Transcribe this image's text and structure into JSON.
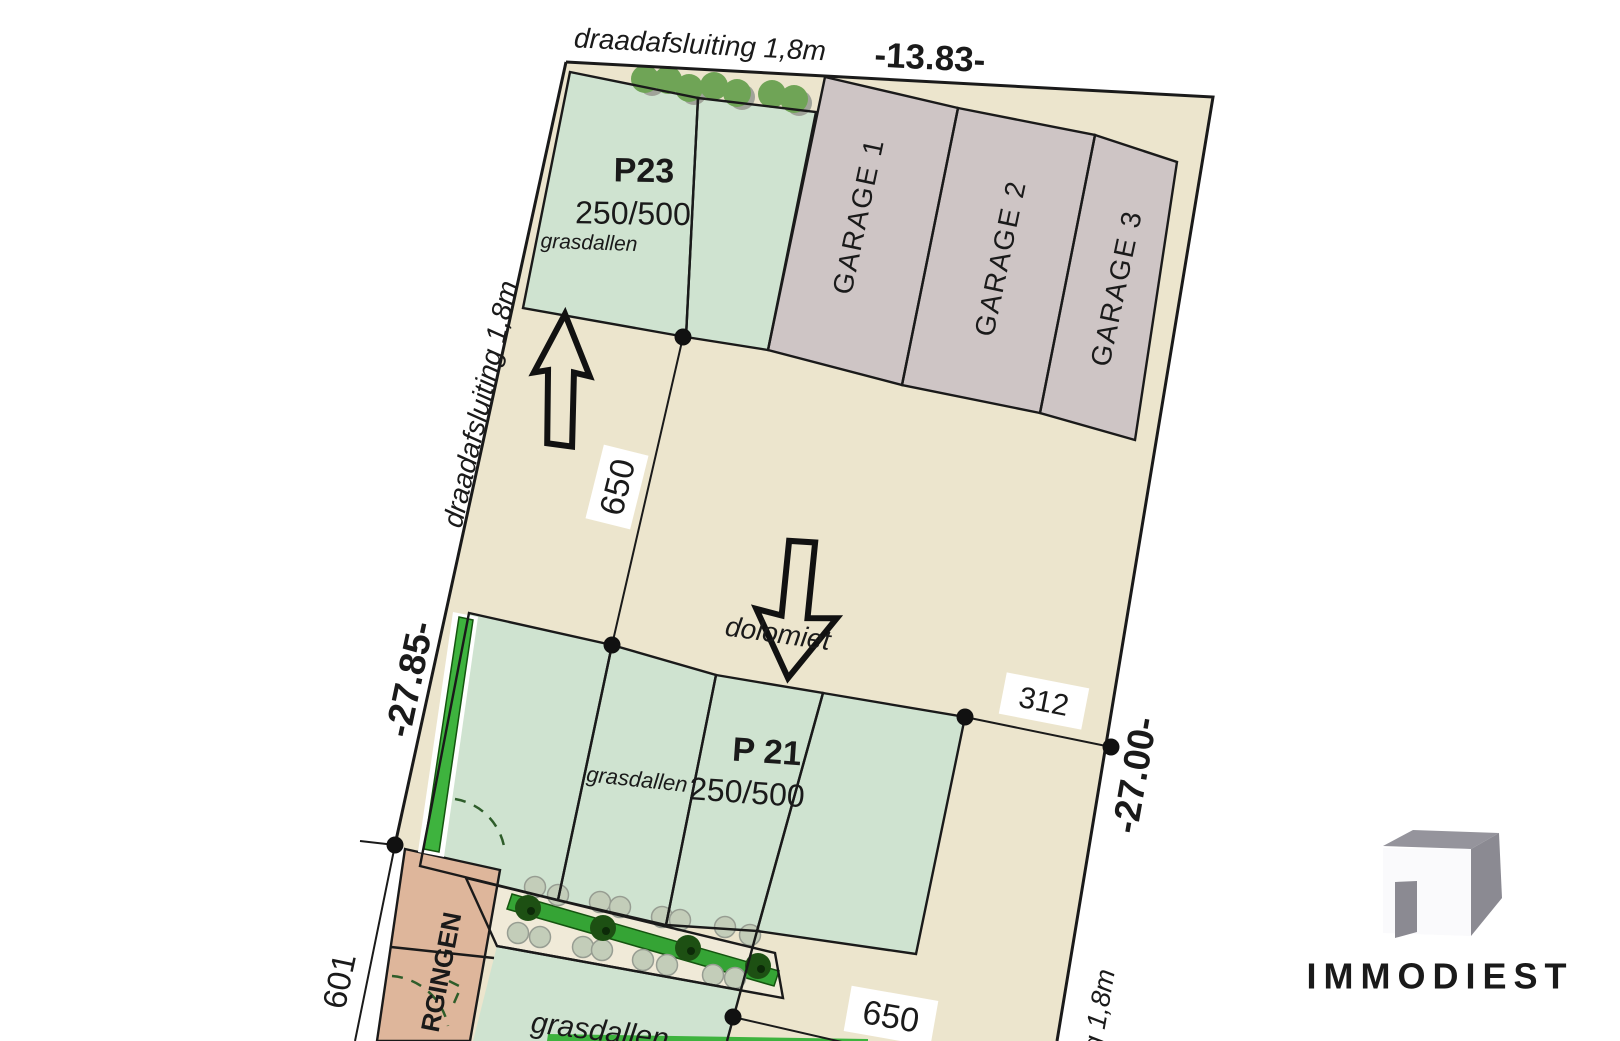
{
  "plan": {
    "boundaries": {
      "top_fence": "draadafsluiting 1,8m",
      "top_length": "-13.83-",
      "left_fence": "draadafsluiting 1,8m",
      "left_length": "-27.85-",
      "right_length": "-27.00-",
      "right_fence": "ting 1,8m"
    },
    "dimensions": {
      "depth_upper": "650",
      "depth_lower": "650",
      "width_312": "312",
      "left_601": "601"
    },
    "p23": {
      "code": "P23",
      "size": "250/500",
      "surface": "grasdallen"
    },
    "p21": {
      "code": "P 21",
      "size": "250/500",
      "surface": "grasdallen"
    },
    "garages": [
      {
        "label": "GARAGE  1"
      },
      {
        "label": "GARAGE  2"
      },
      {
        "label": "GARAGE  3"
      }
    ],
    "labels": {
      "dolomiet": "dolomiet",
      "grasdallen_bottom": "grasdallen",
      "storage": "RGINGEN"
    },
    "watermark": {
      "text": "IMMODIEST"
    },
    "colors": {
      "site": "#ece5cd",
      "stall": "#cfe3d0",
      "garage": "#cec5c5",
      "building": "#deb69b",
      "strip": "#f0ead8",
      "hedge": "#3eb33e",
      "bar": "#35a435",
      "tree": "#1d5013",
      "bush_pale": "#c3cdb9",
      "bush_green": "#6fa456",
      "bush_gray": "#a0a399",
      "code_red": "#c0272d",
      "size_orange": "#d2512e",
      "label_green": "#33a133",
      "logo_gray": "#95949c",
      "logo_dark": "#8b8a92",
      "watermark_gray": "#e4e4e9"
    }
  }
}
